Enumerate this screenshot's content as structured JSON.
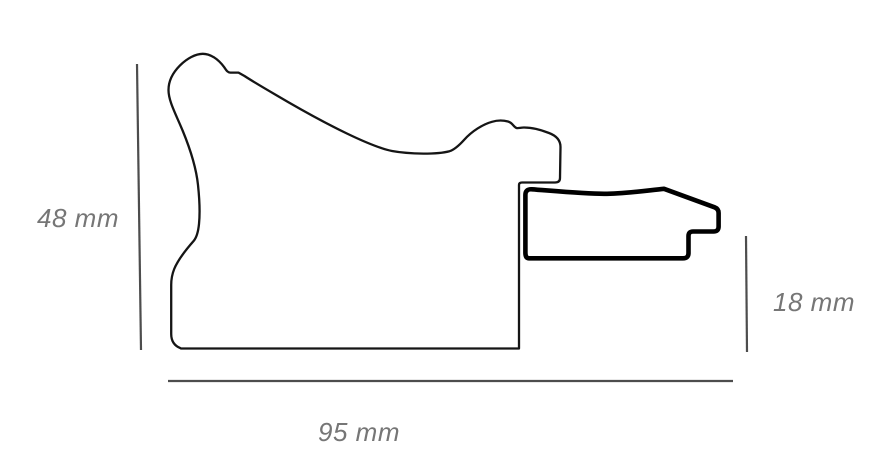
{
  "diagram": {
    "labels": {
      "height": "48 mm",
      "width": "95 mm",
      "insert_height": "18 mm"
    },
    "colors": {
      "background": "#ffffff",
      "profile_outline": "#151515",
      "insert_outline": "#000000",
      "dimension_line": "#4d4d4d",
      "dimension_text": "#767676"
    }
  }
}
